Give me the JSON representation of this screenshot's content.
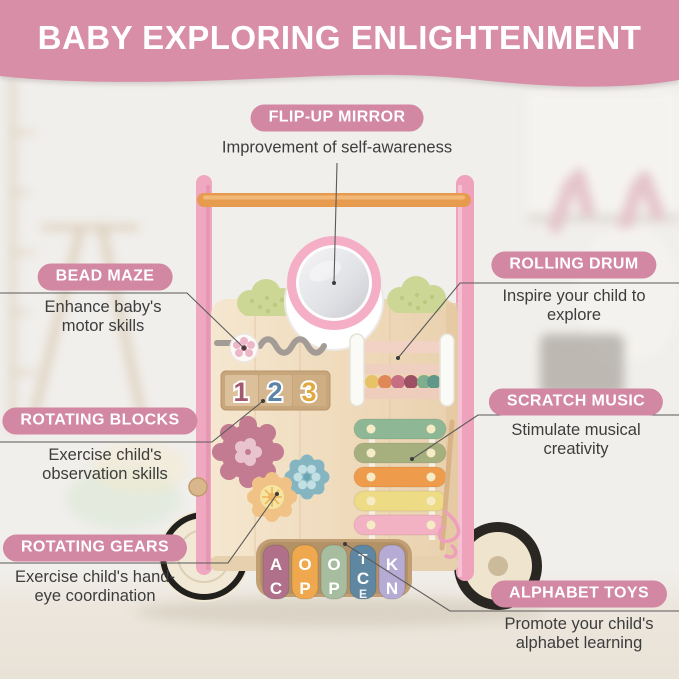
{
  "header": {
    "title": "BABY EXPLORING ENLIGHTENMENT"
  },
  "features": [
    {
      "id": "flip-up-mirror",
      "label": "FLIP-UP MIRROR",
      "description": "Improvement of self-awareness"
    },
    {
      "id": "bead-maze",
      "label": "BEAD MAZE",
      "description": "Enhance baby's motor skills"
    },
    {
      "id": "rotating-blocks",
      "label": "ROTATING BLOCKS",
      "description": "Exercise child's observation skills"
    },
    {
      "id": "rotating-gears",
      "label": "ROTATING GEARS",
      "description": "Exercise child's hand-eye coordination"
    },
    {
      "id": "rolling-drum",
      "label": "ROLLING DRUM",
      "description": "Inspire your child to explore"
    },
    {
      "id": "scratch-music",
      "label": "SCRATCH MUSIC",
      "description": "Stimulate musical creativity"
    },
    {
      "id": "alphabet-toys",
      "label": "ALPHABET TOYS",
      "description": "Promote your child's alphabet learning"
    }
  ],
  "toy": {
    "name": "wooden baby push walker activity center",
    "block_digits": [
      "1",
      "2",
      "3"
    ],
    "letter_wheels": [
      {
        "color": "#b07089",
        "letters": [
          "A",
          "C"
        ]
      },
      {
        "color": "#efa84e",
        "letters": [
          "O",
          "P"
        ]
      },
      {
        "color": "#a7bda0",
        "letters": [
          "O",
          "P"
        ]
      },
      {
        "color": "#5f87a2",
        "letters": [
          "T",
          "C",
          "E"
        ]
      },
      {
        "color": "#b6abd4",
        "letters": [
          "K",
          "N"
        ]
      }
    ]
  },
  "colors": {
    "banner_pink": "#d88ea7",
    "pill_pink": "#d287a2",
    "frame_pink": "#efa3bc",
    "handle_orange": "#e69b4e",
    "board_wood": "#f2e0c6",
    "callout_line": "#5a5a5a",
    "body_text": "#3d3d3d"
  }
}
